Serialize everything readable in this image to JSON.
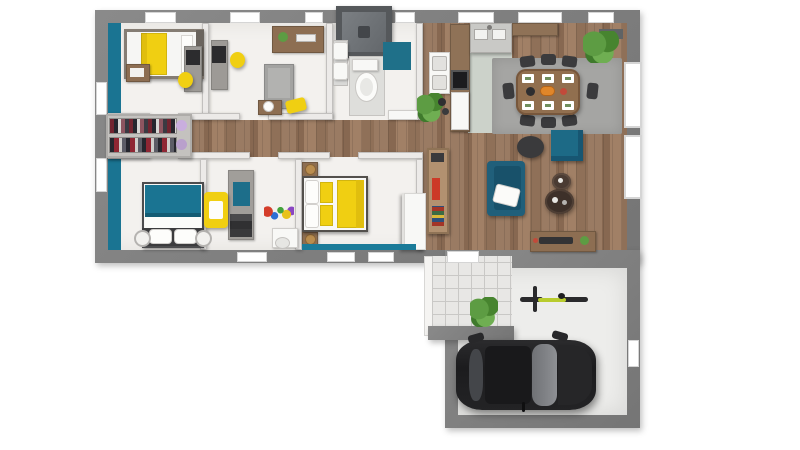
{
  "image": {
    "kind": "3d-rendered-floor-plan",
    "background": "#ffffff"
  },
  "palette": {
    "outer_wall": "#7d7d7d",
    "inner_wall": "#eceae8",
    "floor_white": "#f3f1ee",
    "floor_tile": "#e8e7e5",
    "tile_line": "#c9c8c6",
    "floor_garage": "#ededeb",
    "kitchen_floor": "#ccd2ca",
    "teal": "#1a7492",
    "teal_dark": "#1d627c",
    "yellow": "#f0cf12",
    "rug": "#a5a5a3",
    "chair_dark": "#3b3b3d",
    "wood_furniture": "#8d6e52",
    "white_furniture": "#f8f8f6",
    "gray_furniture": "#9d9a96",
    "plant_green": "#5d9c43",
    "car_body": "#232325",
    "car_glass": "#87898d",
    "red_accent": "#cc3a28",
    "brass": "#b98d4f",
    "bike_frame": "#b9cc2e"
  },
  "rooms": [
    {
      "id": "bedroom-1",
      "label": "bedroom with single yellow bed"
    },
    {
      "id": "bedroom-2",
      "label": "bedroom with desk and daybed"
    },
    {
      "id": "wardrobe-closet",
      "label": "open wardrobe with hanging clothes"
    },
    {
      "id": "bedroom-3",
      "label": "bedroom with teal double bed"
    },
    {
      "id": "bedroom-4",
      "label": "kids room with yellow armchair"
    },
    {
      "id": "master-bedroom",
      "label": "master bedroom with yellow double bed"
    },
    {
      "id": "bathroom",
      "label": "bathroom with shower and toilet"
    },
    {
      "id": "hallway",
      "label": "wood-floor hallway"
    },
    {
      "id": "kitchen",
      "label": "kitchen with counters and stove"
    },
    {
      "id": "dining-area",
      "label": "dining area with table for eight"
    },
    {
      "id": "living-area",
      "label": "living area with teal sofa"
    },
    {
      "id": "entry-porch",
      "label": "tiled entry porch"
    },
    {
      "id": "garage",
      "label": "garage with car and bicycle"
    }
  ],
  "furniture": [
    "single-bed",
    "nightstand",
    "desk-with-monitor",
    "yellow-desk-chair",
    "wall-shelf",
    "gray-daybed",
    "clothes-racks",
    "teal-double-bed",
    "yellow-armchair",
    "study-unit",
    "toys",
    "vanity-table",
    "master-bed",
    "bedside-lamps",
    "white-wardrobe",
    "shower",
    "twin-sinks",
    "toilet",
    "teal-bath-mat",
    "washer-dryer-column",
    "bookshelf",
    "potted-plants",
    "kitchen-counter",
    "stove",
    "kitchen-sink",
    "dining-table",
    "dining-chairs-x8",
    "area-rug",
    "teal-sofa",
    "teal-ottoman",
    "dark-pouf",
    "round-coffee-tables",
    "sideboard",
    "bicycle",
    "black-car"
  ]
}
